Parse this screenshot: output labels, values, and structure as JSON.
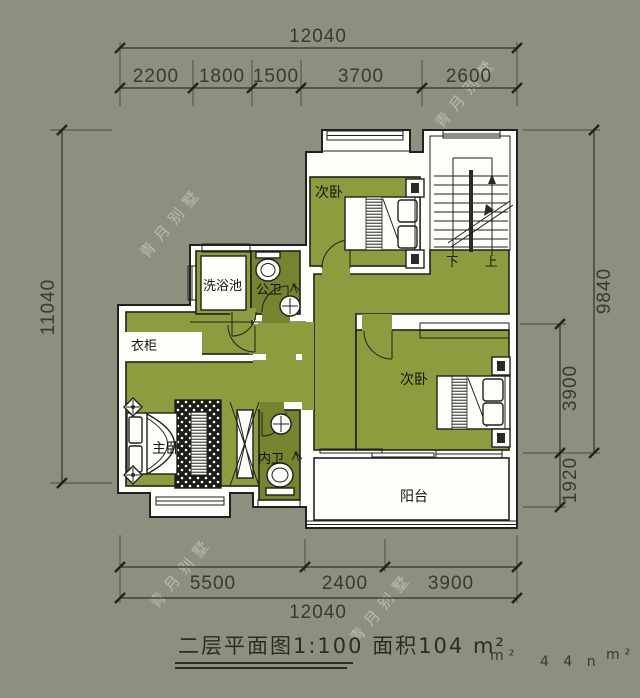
{
  "canvas": {
    "bg": "#8c907e"
  },
  "palette": {
    "floor": "#8e9c40",
    "floor_dark": "#76832f",
    "wall_white": "#fdfdfa",
    "line": "#20201c",
    "dim_text": "#3a3a30"
  },
  "watermark": {
    "text": "青月别墅"
  },
  "dims": {
    "top_total": "12040",
    "top_segs": [
      "2200",
      "1800",
      "1500",
      "3700",
      "2600"
    ],
    "left_total": "11040",
    "right_total": "9840",
    "right_segs": [
      "3900",
      "1920"
    ],
    "bottom_segs": [
      "5500",
      "2400",
      "3900"
    ],
    "bottom_total": "12040"
  },
  "rooms": {
    "bedroom_top": "次卧",
    "bedroom_right": "次卧",
    "master_bedroom": "主卧",
    "wash_pool": "洗浴池",
    "public_bath": "公卫",
    "inner_bath": "内卫",
    "wardrobe": "衣柜",
    "balcony": "阳台",
    "stair_down": "下",
    "stair_up": "上"
  },
  "title": {
    "main": "二层平面图1:100 面积104 m²",
    "frag_a": "m²",
    "frag_b": "4 4 n",
    "frag_c": "m²"
  }
}
